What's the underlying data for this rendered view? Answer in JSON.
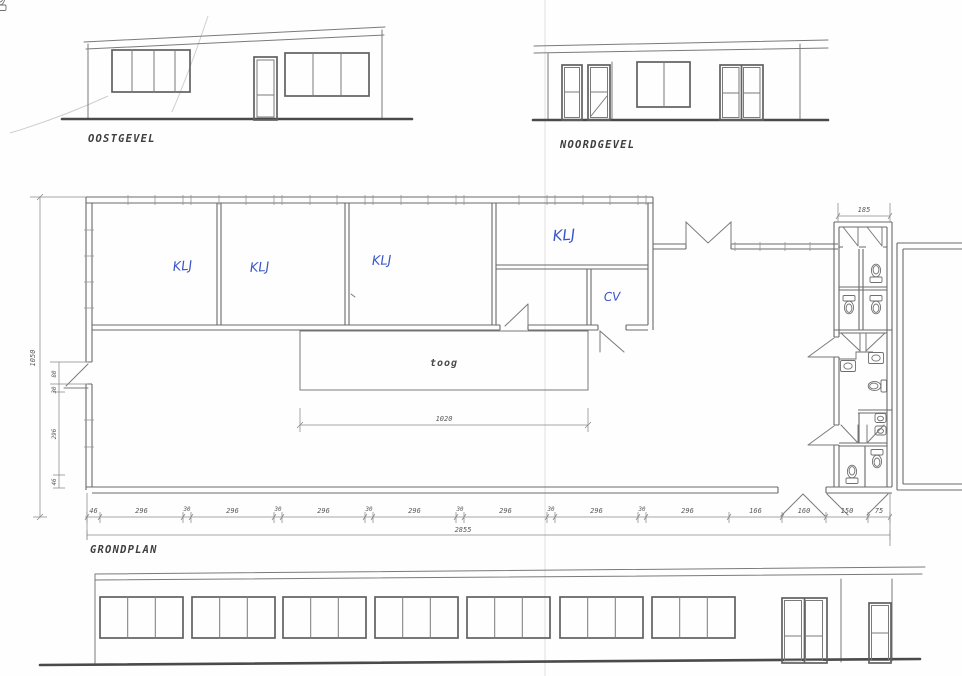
{
  "colors": {
    "paper": "#fefefe",
    "pencil_ink": "#6a6a6a",
    "dark_ink": "#4a4a4a",
    "handwriting_blue": "#3a55c5"
  },
  "elevations": {
    "east": {
      "label": "OOSTGEVEL"
    },
    "north": {
      "label": "NOORDGEVEL"
    }
  },
  "floor_plan": {
    "label": "GRONDPLAN",
    "rooms": {
      "klj_1": "KLJ",
      "klj_2": "KLJ",
      "klj_3": "KLJ",
      "klj_4": "KLJ",
      "cv": "CV",
      "bar": "toog"
    },
    "dimensions": {
      "overall_width": "2855",
      "overall_depth": "1050",
      "bar_length": "1020",
      "sanitary_width": "185",
      "left_side": [
        "80",
        "30",
        "296",
        "46"
      ],
      "bottom": [
        "46",
        "296",
        "30",
        "296",
        "30",
        "296",
        "30",
        "296",
        "30",
        "296",
        "30",
        "296",
        "30",
        "296",
        "166",
        "160",
        "150",
        "75"
      ]
    }
  }
}
